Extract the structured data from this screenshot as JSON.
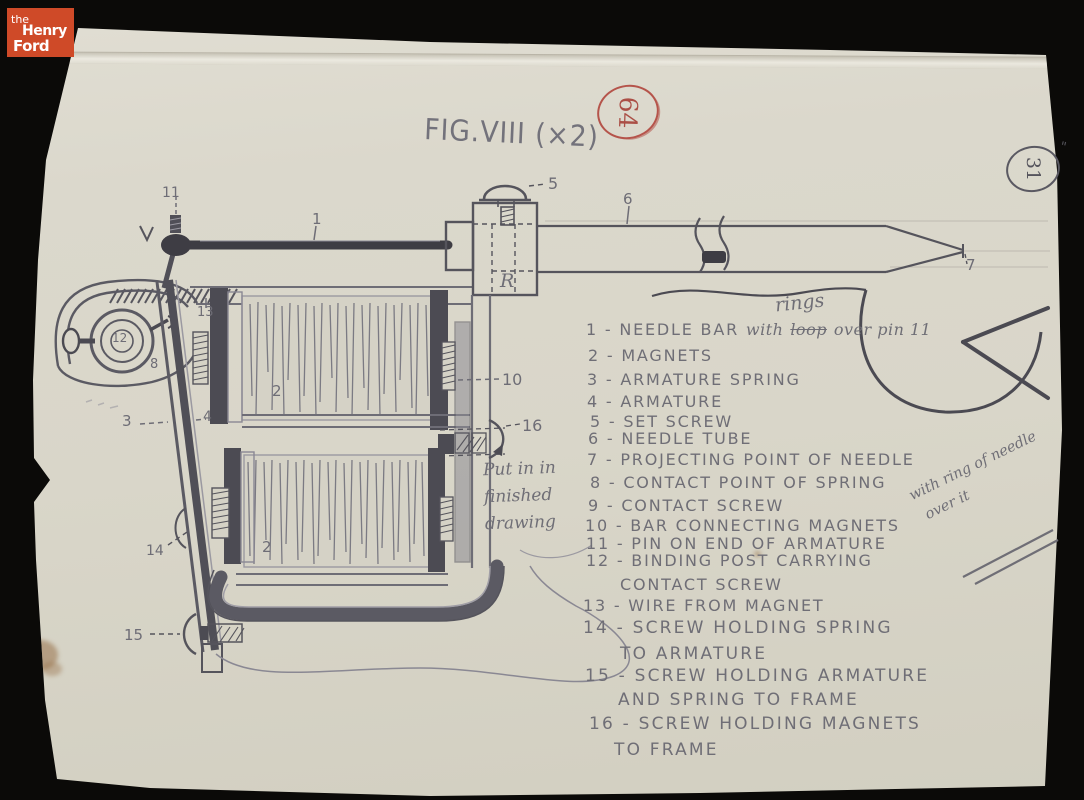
{
  "branding": {
    "logo_the": "the",
    "logo_henry": "Henry",
    "logo_ford": "Ford"
  },
  "figure": {
    "title": "FIG.VIII (×2)"
  },
  "marks": {
    "red_circle_number": "64",
    "corner_circle_number": "31",
    "ditto": "\""
  },
  "notes": {
    "rings": "rings",
    "put_in_line1": "Put in in",
    "put_in_line2": "finished",
    "put_in_line3": "drawing",
    "ring_note_line1": "with ring of needle",
    "ring_note_line2": "over it"
  },
  "part_labels": {
    "n1": "1",
    "n2": "2",
    "n3": "3",
    "n4": "4",
    "n5": "5",
    "n6": "6",
    "n7": "7",
    "n8": "8",
    "n10": "10",
    "n11": "11",
    "n12": "12",
    "n13": "13",
    "n14": "14",
    "n15": "15",
    "n16": "16",
    "r": "R"
  },
  "legend": {
    "item1_printed": "1 - NEEDLE BAR",
    "item1_cursive_pre": "with",
    "item1_struck": "loop",
    "item1_cursive_post": "over pin 11",
    "lines": [
      "2 - MAGNETS",
      "3 - ARMATURE SPRING",
      "4 - ARMATURE",
      "5 - SET SCREW",
      "6 - NEEDLE TUBE",
      "7 - PROJECTING POINT OF NEEDLE",
      "8 - CONTACT POINT OF SPRING",
      "9 - CONTACT SCREW",
      "10 - BAR CONNECTING MAGNETS",
      "11 - PIN ON END OF ARMATURE",
      "12 - BINDING POST CARRYING",
      "CONTACT SCREW",
      "13 - WIRE FROM MAGNET",
      "14 - SCREW HOLDING SPRING",
      "TO ARMATURE",
      "15 - SCREW HOLDING ARMATURE",
      "AND SPRING TO FRAME",
      "16 - SCREW HOLDING MAGNETS",
      "TO FRAME"
    ]
  },
  "colors": {
    "background": "#0b0a08",
    "paper": "#dbd8cc",
    "pencil": "#6e6d76",
    "pencil_dark": "#44434b",
    "red_pencil": "#b5544b",
    "logo_red": "#cf4a28"
  }
}
